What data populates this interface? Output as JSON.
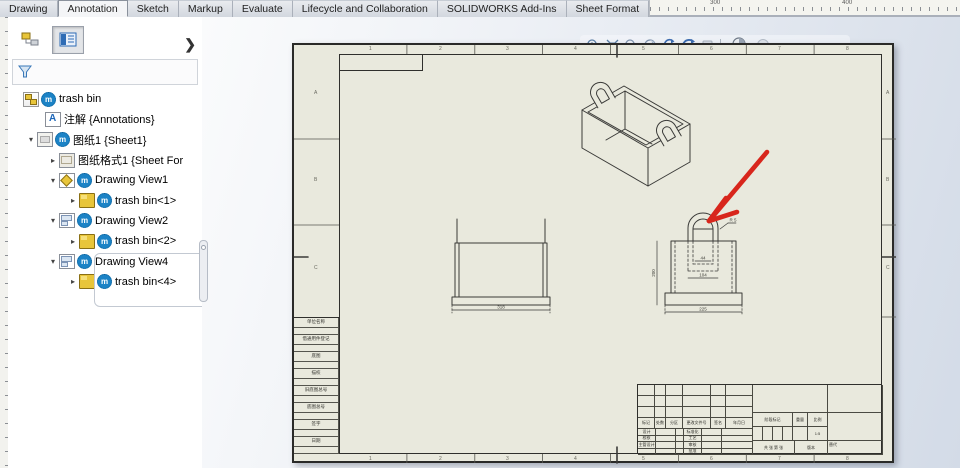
{
  "window": {
    "tabs": [
      {
        "label": "Drawing",
        "active": false
      },
      {
        "label": "Annotation",
        "active": true
      },
      {
        "label": "Sketch",
        "active": false
      },
      {
        "label": "Markup",
        "active": false
      },
      {
        "label": "Evaluate",
        "active": false
      },
      {
        "label": "Lifecycle and Collaboration",
        "active": false
      },
      {
        "label": "SOLIDWORKS Add-Ins",
        "active": false
      },
      {
        "label": "Sheet Format",
        "active": false
      }
    ],
    "ruler": {
      "label_300": "300",
      "label_400": "400"
    }
  },
  "panel": {
    "collapse_arrow": "❯",
    "tree": {
      "items": [
        {
          "label": "trash bin"
        },
        {
          "label": "注解 {Annotations}"
        },
        {
          "label": "图纸1 {Sheet1}"
        },
        {
          "label": "图纸格式1 {Sheet For"
        },
        {
          "label": "Drawing View1"
        },
        {
          "label": "trash bin<1>"
        },
        {
          "label": "Drawing View2"
        },
        {
          "label": "trash bin<2>"
        },
        {
          "label": "Drawing View4"
        },
        {
          "label": "trash bin<4>"
        }
      ],
      "gear_overlay": "m",
      "expander_open": "▾",
      "expander_closed": "▸"
    }
  },
  "toolbar_icons": [
    "zoom-to-area",
    "zoom-to-fit",
    "zoom",
    "section-view",
    "rotate-view",
    "3d-drawing-view",
    "draft-quality",
    "view-orientation",
    "display-style"
  ],
  "sheet": {
    "paper_color": "#e9e9dd",
    "zones_bottom": [
      "1",
      "2",
      "3",
      "4",
      "5",
      "6",
      "7",
      "8"
    ],
    "zones_side": [
      "A",
      "B",
      "C"
    ],
    "edge_labels": [
      "单位名称",
      "借通用件登记",
      "底图",
      "描校",
      "旧底图总号",
      "底图总号",
      "签字",
      "日期"
    ],
    "dims": {
      "front_width": "318",
      "side_width": "225",
      "side_height": "200",
      "handle_width": "104",
      "handle_inner": "44",
      "radius": "R 5"
    },
    "titleblock": {
      "rev_labels": [
        "标记",
        "处数",
        "分区",
        "更改文件号",
        "签名",
        "年月日"
      ],
      "row_labels_left": [
        "设计",
        "校核",
        "主管设计",
        ""
      ],
      "row_labels_right": [
        "标准化",
        "工艺",
        "审核",
        "批准"
      ],
      "stage_label": "阶段标记",
      "weight_label": "重量",
      "scale_label": "比例",
      "scale_value": "1:5",
      "sheets_label": "共 张 第 张",
      "version_label": "版本",
      "replace_label": "替代"
    },
    "annotation_arrow_color": "#d8261c"
  }
}
